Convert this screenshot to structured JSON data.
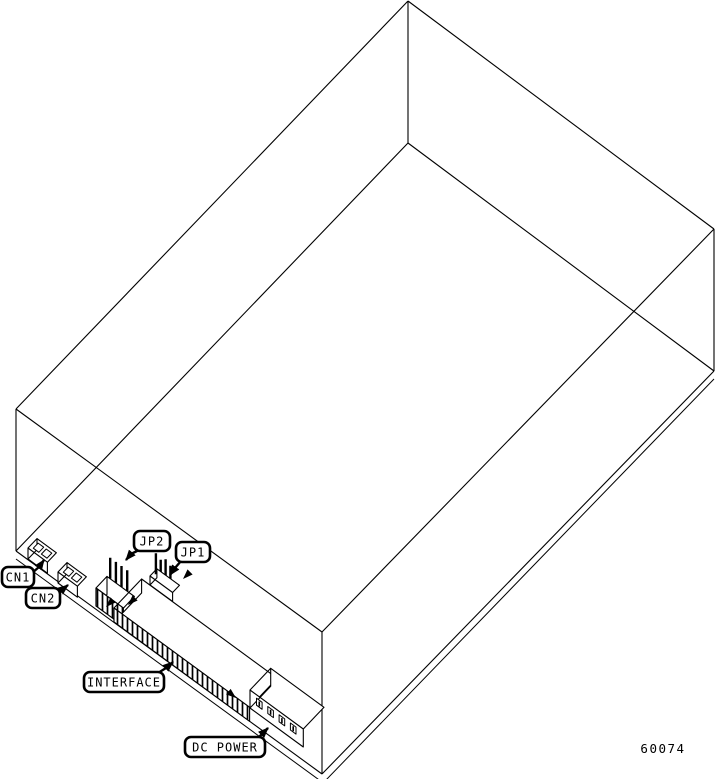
{
  "figure": {
    "number": "60074"
  },
  "callouts": {
    "cn1": "CN1",
    "cn2": "CN2",
    "jp2": "JP2",
    "jp1": "JP1",
    "interface": "INTERFACE",
    "dc_power": "DC POWER"
  },
  "colors": {
    "ink": "#000000",
    "paper": "#ffffff"
  }
}
